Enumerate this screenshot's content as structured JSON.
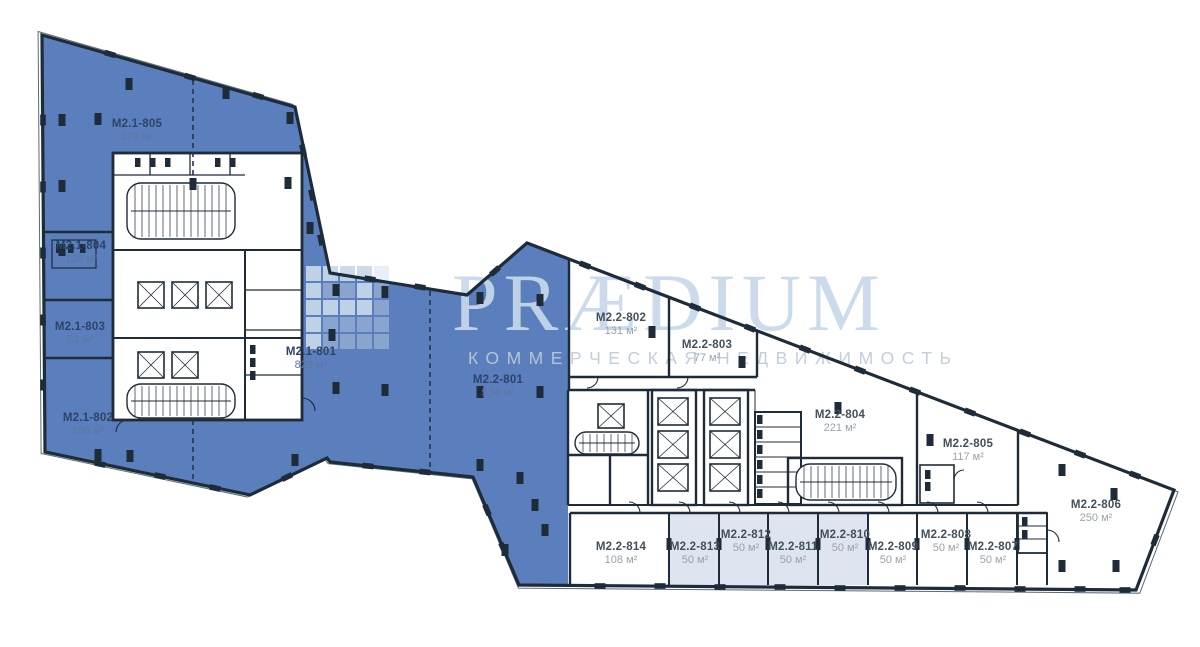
{
  "watermark": {
    "brand": "PRÆDIUM",
    "subtitle": "КОММЕРЧЕСКАЯ НЕДВИЖИМОСТЬ"
  },
  "colors": {
    "unit_blue": "#5b7fbc",
    "unit_shaded": "#dfe5f0",
    "wall": "#1e2c3a",
    "watermark": "#c7d9ea",
    "watermark_sub": "#bdcad8",
    "label_dark": "#42505c",
    "label_area": "#98a2ac",
    "label_blue": "#2d4469",
    "label_blue_area": "#5b76a5"
  },
  "units": [
    {
      "id": "M2.1-805",
      "area": "329 м²",
      "x": 137,
      "y": 131,
      "zone": "blue"
    },
    {
      "id": "M2.1-804",
      "area": "108 м²",
      "x": 81,
      "y": 253,
      "zone": "blue"
    },
    {
      "id": "M2.1-803",
      "area": "53 м²",
      "x": 80,
      "y": 334,
      "zone": "blue"
    },
    {
      "id": "M2.1-802",
      "area": "198 м²",
      "x": 88,
      "y": 425,
      "zone": "blue"
    },
    {
      "id": "M2.1-801",
      "area": "829 м²",
      "x": 311,
      "y": 359,
      "zone": "blue"
    },
    {
      "id": "M2.2-801",
      "area": "534 м²",
      "x": 498,
      "y": 387,
      "zone": "blue"
    },
    {
      "id": "M2.2-802",
      "area": "131 м²",
      "x": 621,
      "y": 325,
      "zone": "white"
    },
    {
      "id": "M2.2-803",
      "area": "77 м²",
      "x": 707,
      "y": 352,
      "zone": "white"
    },
    {
      "id": "M2.2-804",
      "area": "221 м²",
      "x": 840,
      "y": 422,
      "zone": "white"
    },
    {
      "id": "M2.2-805",
      "area": "117 м²",
      "x": 968,
      "y": 451,
      "zone": "white"
    },
    {
      "id": "M2.2-806",
      "area": "250 м²",
      "x": 1096,
      "y": 512,
      "zone": "white"
    },
    {
      "id": "M2.2-807",
      "area": "50 м²",
      "x": 993,
      "y": 554,
      "zone": "white"
    },
    {
      "id": "M2.2-808",
      "area": "50 м²",
      "x": 946,
      "y": 542,
      "zone": "white"
    },
    {
      "id": "M2.2-809",
      "area": "50 м²",
      "x": 893,
      "y": 554,
      "zone": "white"
    },
    {
      "id": "M2.2-810",
      "area": "50 м²",
      "x": 845,
      "y": 542,
      "zone": "shaded"
    },
    {
      "id": "M2.2-811",
      "area": "50 м²",
      "x": 793,
      "y": 554,
      "zone": "shaded"
    },
    {
      "id": "M2.2-812",
      "area": "50 м²",
      "x": 746,
      "y": 542,
      "zone": "shaded"
    },
    {
      "id": "M2.2-813",
      "area": "50 м²",
      "x": 695,
      "y": 554,
      "zone": "shaded"
    },
    {
      "id": "M2.2-814",
      "area": "108 м²",
      "x": 621,
      "y": 554,
      "zone": "white"
    }
  ]
}
